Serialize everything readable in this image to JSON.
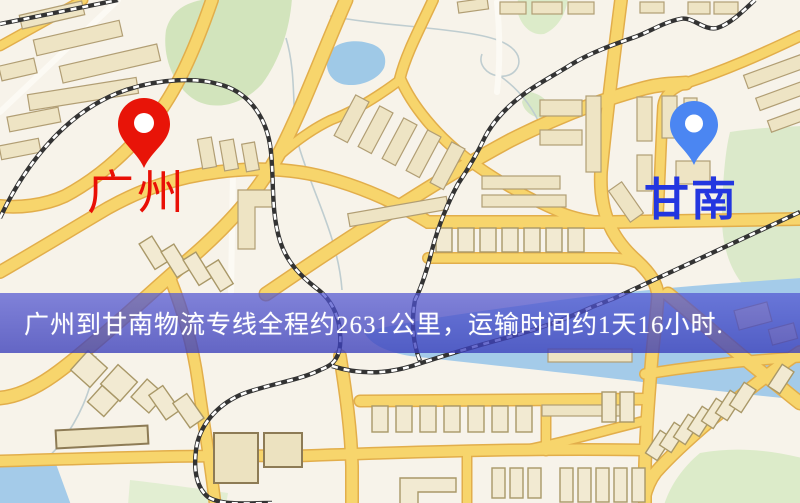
{
  "route_banner": {
    "text": "广州到甘南物流专线全程约2631公里，运输时间约1天16小时.",
    "distance_text": "约2631公里",
    "duration_text": "约1天16小时",
    "background_color": "#4a4ec6",
    "text_color": "#ffffff"
  },
  "pins": {
    "origin": {
      "label": "广州",
      "color": "#e81408",
      "label_color": "#e90f06"
    },
    "destination": {
      "label": "甘南",
      "color": "#4b86f2",
      "label_color": "#2336e0"
    }
  },
  "map": {
    "background_color": "#f7f3ea",
    "road_color": "#f7d56c",
    "park_color": "#d7e7c3",
    "water_color": "#a3cbe8",
    "railway_color": "#333333"
  }
}
